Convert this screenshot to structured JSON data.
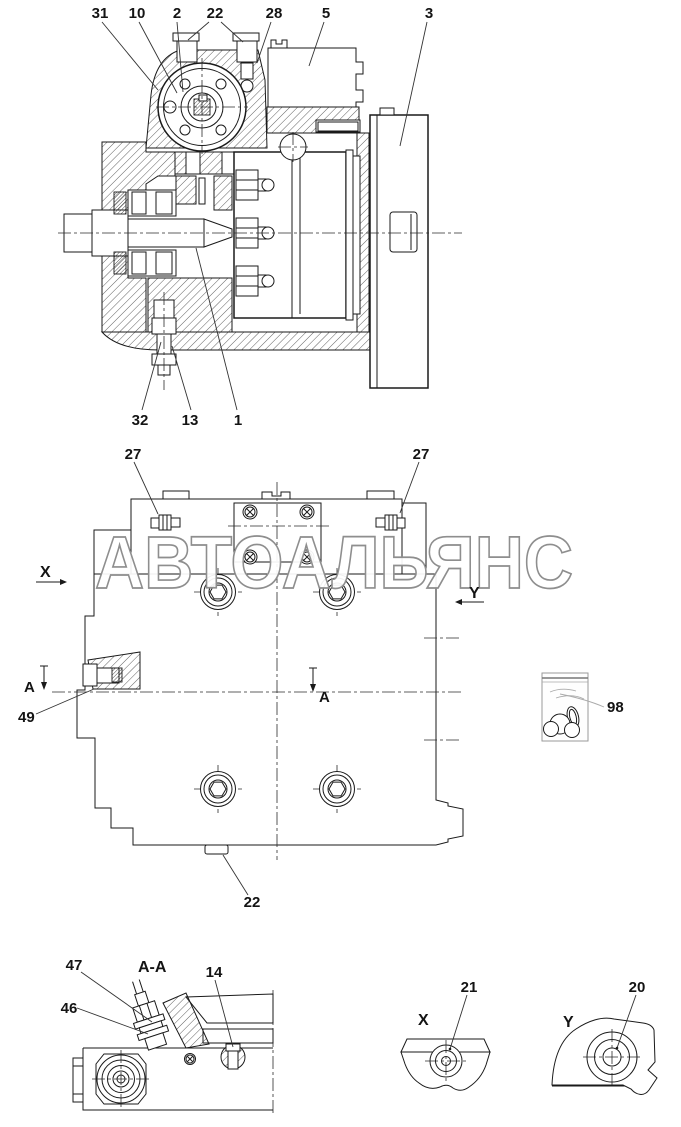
{
  "watermark": {
    "text": "АВТОАЛЬЯНС",
    "color": "#8e8e8e"
  },
  "line_color": "#1a1a1a",
  "main_section_view": {
    "callouts": {
      "c31": "31",
      "c10": "10",
      "c2": "2",
      "c22": "22",
      "c28": "28",
      "c5": "5",
      "c3": "3",
      "c32": "32",
      "c13": "13",
      "c1": "1"
    }
  },
  "side_view": {
    "callouts": {
      "c27_left": "27",
      "c27_right": "27",
      "c49": "49",
      "c98": "98",
      "c22_bottom": "22"
    },
    "markers": {
      "x": "X",
      "y": "Y",
      "a_left": "A",
      "a_mid": "A"
    }
  },
  "section_aa_view": {
    "title": "A-A",
    "callouts": {
      "c47": "47",
      "c46": "46",
      "c14": "14"
    }
  },
  "detail_x_view": {
    "title": "X",
    "callouts": {
      "c21": "21"
    }
  },
  "detail_y_view": {
    "title": "Y",
    "callouts": {
      "c20": "20"
    }
  }
}
